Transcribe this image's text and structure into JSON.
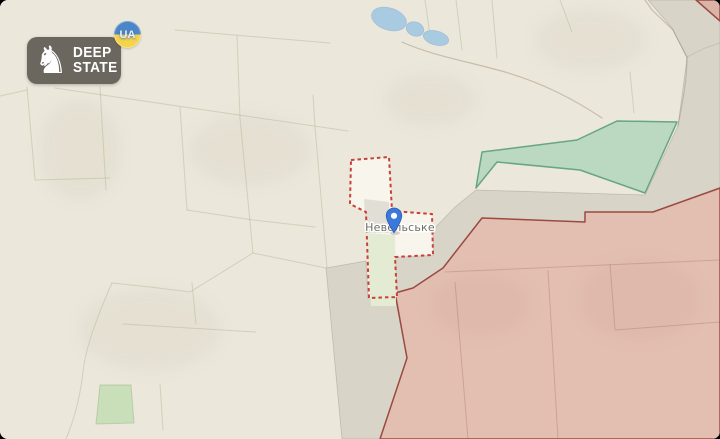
{
  "app": {
    "brand": {
      "line1": "DEEP",
      "line2": "STATE",
      "badge": "UA",
      "knight_icon": "chess-knight",
      "logo_bg": "#615d55",
      "badge_blue": "#4a86c8",
      "badge_yellow": "#f3d44c"
    }
  },
  "map": {
    "place_label": "Невельське",
    "marker": {
      "type": "location-pin",
      "color": "#3b78dc"
    },
    "regions": {
      "liberated_green": "#8fcda6",
      "occupied_red": "#d98d7e",
      "grey_zone": "#b4ada1",
      "contested_dash": "#c8403a",
      "water": "#a9cbe2",
      "vegetation": "#c9dfba",
      "village_green": "#e3ecd2",
      "village_fill": "#f8f5ec"
    }
  }
}
